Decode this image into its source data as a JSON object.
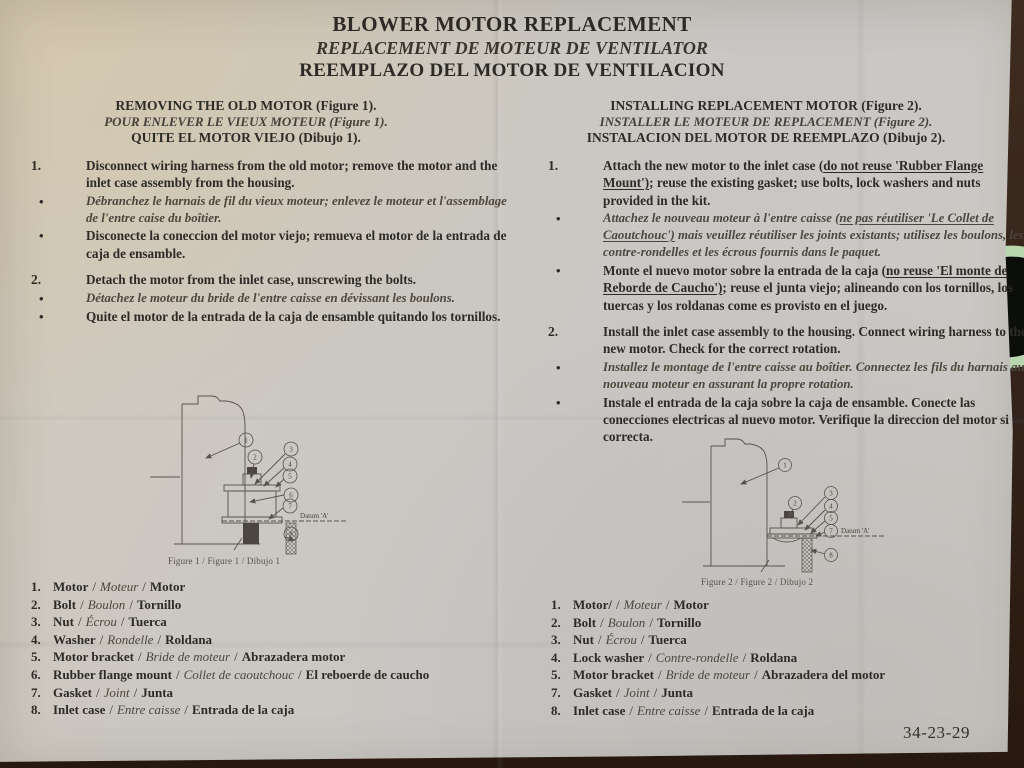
{
  "misc": {
    "bullet": "•",
    "slash": "/"
  },
  "title": {
    "en": "BLOWER MOTOR REPLACEMENT",
    "fr": "REPLACEMENT DE MOTEUR DE VENTILATOR",
    "es": "REEMPLAZO DEL MOTOR DE VENTILACION"
  },
  "doc_number": "34-23-29",
  "left_section": {
    "heading_en": "REMOVING THE OLD MOTOR (Figure 1).",
    "heading_fr": "POUR ENLEVER LE VIEUX MOTEUR (Figure 1).",
    "heading_es": "QUITE EL MOTOR VIEJO (Dibujo 1).",
    "steps": [
      {
        "number": "1.",
        "en": "Disconnect wiring harness from the old motor; remove the motor and the inlet case assembly from the housing.",
        "fr": "Débranchez le harnais de fil du vieux moteur; enlevez le moteur et l'assemblage de l'entre caise du boîtier.",
        "es": "Disconecte la coneccion del motor viejo; remueva el motor de la entrada de caja de ensamble."
      },
      {
        "number": "2.",
        "en": "Detach the motor from the inlet case, unscrewing the bolts.",
        "fr": "Détachez le moteur du bride de l'entre caisse en dévissant les boulons.",
        "es": "Quite el motor de la entrada de la caja de ensamble quitando los tornillos."
      }
    ],
    "figure": {
      "caption": "Figure 1 / Figure 1 / Dibujo 1",
      "datum": "Datum 'A'",
      "balloons": [
        "1",
        "2",
        "3",
        "4",
        "5",
        "6",
        "7",
        "8"
      ]
    },
    "parts": [
      {
        "num": "1.",
        "en": "Motor",
        "fr": "Moteur",
        "es": "Motor"
      },
      {
        "num": "2.",
        "en": "Bolt",
        "fr": "Boulon",
        "es": "Tornillo"
      },
      {
        "num": "3.",
        "en": "Nut",
        "fr": "Écrou",
        "es": "Tuerca"
      },
      {
        "num": "4.",
        "en": "Washer",
        "fr": "Rondelle",
        "es": "Roldana"
      },
      {
        "num": "5.",
        "en": "Motor bracket",
        "fr": "Bride de moteur",
        "es": "Abrazadera motor"
      },
      {
        "num": "6.",
        "en": "Rubber flange mount",
        "fr": "Collet de caoutchouc",
        "es": "El reboerde de caucho"
      },
      {
        "num": "7.",
        "en": "Gasket",
        "fr": "Joint",
        "es": "Junta"
      },
      {
        "num": "8.",
        "en": "Inlet case",
        "fr": "Entre caisse",
        "es": "Entrada de la caja"
      }
    ]
  },
  "right_section": {
    "heading_en": "INSTALLING REPLACEMENT MOTOR (Figure 2).",
    "heading_fr": "INSTALLER LE MOTEUR DE REPLACEMENT (Figure 2).",
    "heading_es": "INSTALACION DEL MOTOR DE REEMPLAZO (Dibujo 2).",
    "step1": {
      "number": "1.",
      "en_pre": "Attach the new motor to the inlet case (",
      "en_u": "do not reuse 'Rubber Flange Mount')",
      "en_post": "; reuse the existing gasket; use bolts, lock washers and nuts provided in the kit.",
      "fr_pre": "Attachez le nouveau moteur à l'entre caisse (",
      "fr_u": "ne pas réutiliser 'Le Collet de Caoutchouc')",
      "fr_post": " mais veuillez réutiliser les joints existants; utilisez les boulons, les contre-rondelles et les écrous fournis dans le paquet.",
      "es_pre": "Monte el nuevo motor sobre la entrada de la caja (",
      "es_u": "no reuse 'El monte de Reborde de Caucho')",
      "es_post": "; reuse el junta viejo; alineando con los tornillos, los tuercas y los roldanas come es provisto en el juego."
    },
    "step2": {
      "number": "2.",
      "en": "Install the inlet case assembly to the housing.  Connect wiring harness to the new motor. Check for the correct rotation.",
      "fr": "Installez le montage de l'entre caisse au boîtier. Connectez les fils du harnais au nouveau moteur en assurant la propre rotation.",
      "es": "Instale el entrada de la caja sobre la caja de ensamble.  Conecte las conecciones electricas al nuevo motor.  Verifique la direccion del motor si es correcta."
    },
    "figure": {
      "caption": "Figure 2 / Figure 2 / Dibujo 2",
      "datum": "Datum 'A'",
      "balloons": [
        "1",
        "2",
        "3",
        "4",
        "5",
        "7",
        "8"
      ]
    },
    "parts": [
      {
        "num": "1.",
        "en": "Motor/",
        "fr": "Moteur",
        "es": "Motor"
      },
      {
        "num": "2.",
        "en": "Bolt",
        "fr": "Boulon",
        "es": "Tornillo"
      },
      {
        "num": "3.",
        "en": "Nut",
        "fr": "Écrou",
        "es": "Tuerca"
      },
      {
        "num": "4.",
        "en": "Lock washer",
        "fr": "Contre-rondelle",
        "es": "Roldana"
      },
      {
        "num": "5.",
        "en": "Motor bracket",
        "fr": "Bride de moteur",
        "es": "Abrazadera del motor"
      },
      {
        "num": "7.",
        "en": "Gasket",
        "fr": "Joint",
        "es": "Junta"
      },
      {
        "num": "8.",
        "en": "Inlet case",
        "fr": "Entre caisse",
        "es": "Entrada de la caja"
      }
    ]
  }
}
